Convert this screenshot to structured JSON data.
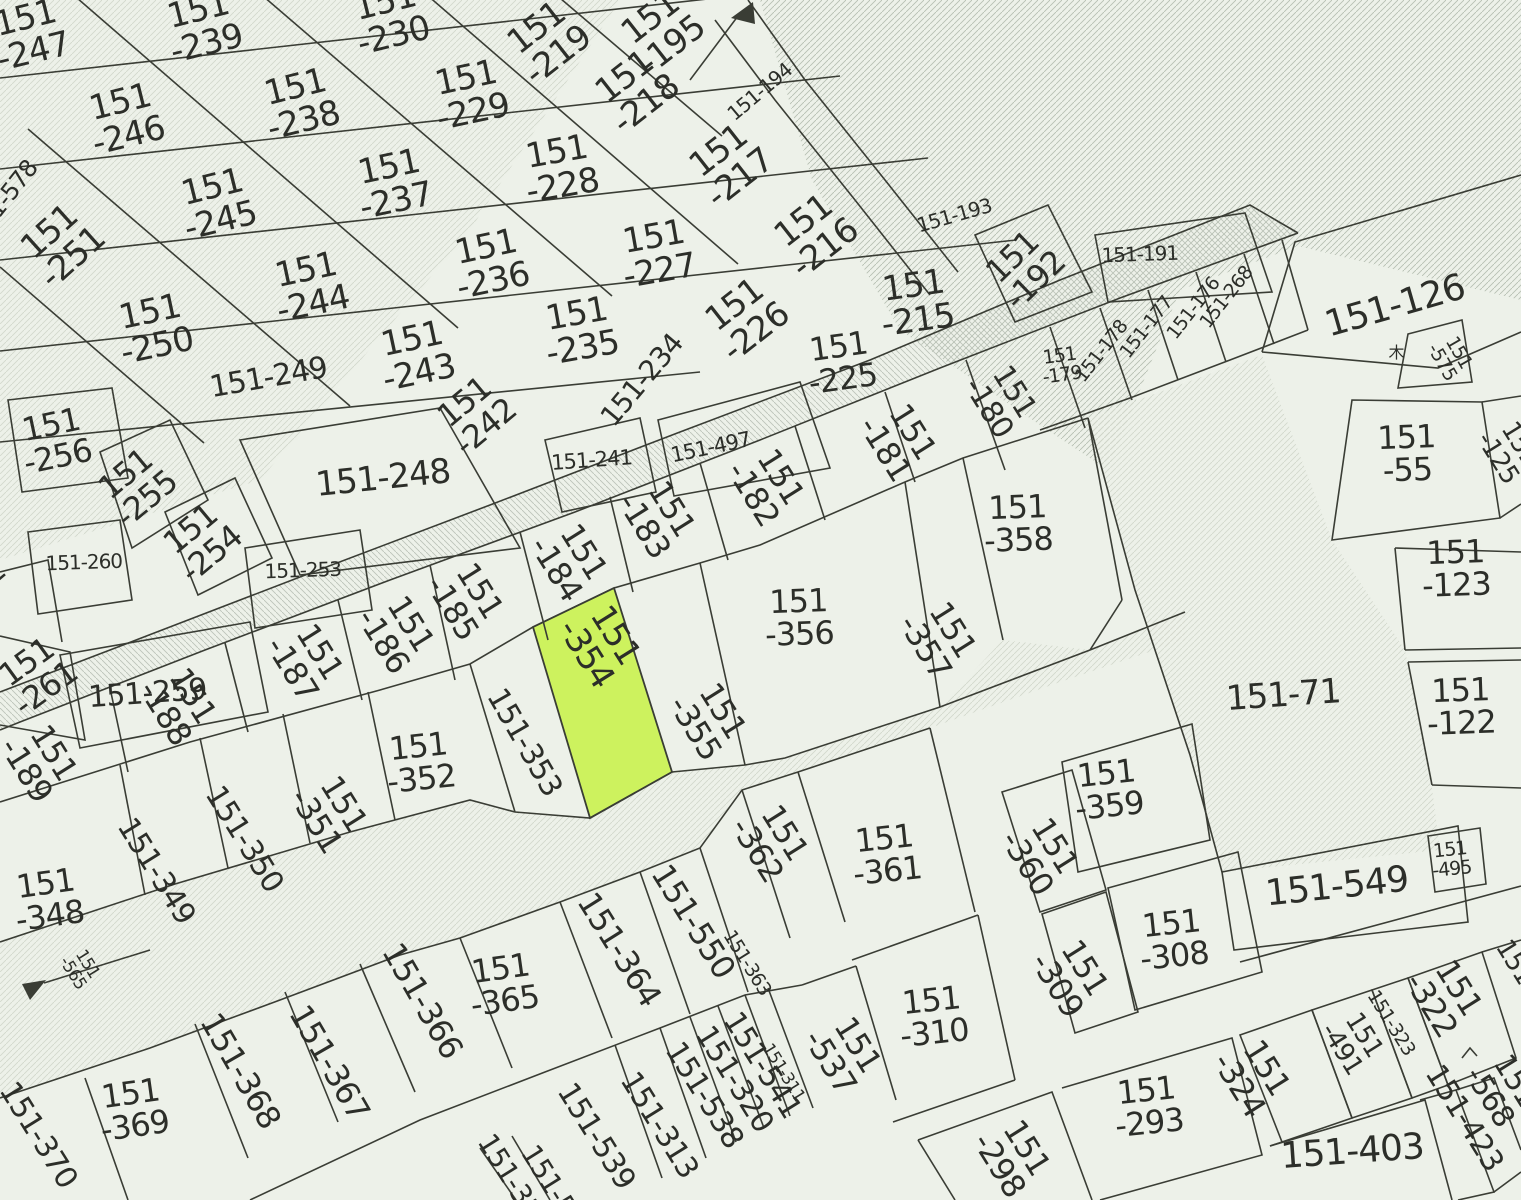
{
  "map": {
    "title": "cadastral-parcel-map",
    "width": 1521,
    "height": 1200,
    "background_color": "#edf1e9",
    "line_color": "#3a3d35",
    "label_color": "#2c2e29",
    "highlight_color": "#cdf25e",
    "hatch_color_strong": "#b7c0b3",
    "hatch_color_mid": "#bcc4ba",
    "hatch_color_faint": "#d2d8cc",
    "highlighted_parcel": "151-354",
    "tree_symbol": "木"
  },
  "parcels": [
    {
      "t": "151-247",
      "x": 30,
      "y": 38,
      "r": -14,
      "s": 34,
      "l": 2
    },
    {
      "t": "151-239",
      "x": 203,
      "y": 30,
      "r": -14,
      "s": 34,
      "l": 2
    },
    {
      "t": "151-230",
      "x": 390,
      "y": 22,
      "r": -14,
      "s": 34,
      "l": 2
    },
    {
      "t": "151-219",
      "x": 549,
      "y": 44,
      "r": -38,
      "s": 34,
      "l": 2
    },
    {
      "t": "151-195",
      "x": 663,
      "y": 34,
      "r": -38,
      "s": 34,
      "l": 2
    },
    {
      "t": "151-246",
      "x": 125,
      "y": 122,
      "r": -14,
      "s": 34,
      "l": 2
    },
    {
      "t": "151-238",
      "x": 300,
      "y": 107,
      "r": -14,
      "s": 34,
      "l": 2
    },
    {
      "t": "151-229",
      "x": 470,
      "y": 98,
      "r": -12,
      "s": 34,
      "l": 2
    },
    {
      "t": "151-218",
      "x": 637,
      "y": 93,
      "r": -38,
      "s": 34,
      "l": 2
    },
    {
      "t": "151-194",
      "x": 764,
      "y": 97,
      "r": -40,
      "s": 20,
      "l": 1
    },
    {
      "t": "151-245",
      "x": 217,
      "y": 207,
      "r": -14,
      "s": 34,
      "l": 2
    },
    {
      "t": "151-237",
      "x": 393,
      "y": 187,
      "r": -12,
      "s": 34,
      "l": 2
    },
    {
      "t": "151-228",
      "x": 560,
      "y": 172,
      "r": -10,
      "s": 34,
      "l": 2
    },
    {
      "t": "151-217",
      "x": 731,
      "y": 167,
      "r": -38,
      "s": 34,
      "l": 2
    },
    {
      "t": "151-578",
      "x": 10,
      "y": 205,
      "r": -52,
      "s": 24,
      "l": 1
    },
    {
      "t": "151-251",
      "x": 63,
      "y": 247,
      "r": -42,
      "s": 34,
      "l": 2
    },
    {
      "t": "151-244",
      "x": 310,
      "y": 290,
      "r": -12,
      "s": 34,
      "l": 2
    },
    {
      "t": "151-236",
      "x": 490,
      "y": 267,
      "r": -12,
      "s": 34,
      "l": 2
    },
    {
      "t": "151-227",
      "x": 657,
      "y": 257,
      "r": -10,
      "s": 34,
      "l": 2
    },
    {
      "t": "151-216",
      "x": 816,
      "y": 237,
      "r": -38,
      "s": 34,
      "l": 2
    },
    {
      "t": "151-193",
      "x": 956,
      "y": 222,
      "r": -16,
      "s": 20,
      "l": 1
    },
    {
      "t": "151-192",
      "x": 1026,
      "y": 271,
      "r": -44,
      "s": 32,
      "l": 2
    },
    {
      "t": "151-191",
      "x": 1140,
      "y": 261,
      "r": -2,
      "s": 20,
      "l": 1
    },
    {
      "t": "151-250",
      "x": 154,
      "y": 332,
      "r": -12,
      "s": 34,
      "l": 2
    },
    {
      "t": "151-243",
      "x": 416,
      "y": 359,
      "r": -12,
      "s": 34,
      "l": 2
    },
    {
      "t": "151-235",
      "x": 580,
      "y": 334,
      "r": -10,
      "s": 34,
      "l": 2
    },
    {
      "t": "151-226",
      "x": 747,
      "y": 321,
      "r": -38,
      "s": 34,
      "l": 2
    },
    {
      "t": "151-215",
      "x": 916,
      "y": 306,
      "r": -8,
      "s": 34,
      "l": 2
    },
    {
      "t": "151-257",
      "x": -50,
      "y": 362,
      "r": -52,
      "s": 30,
      "l": 1
    },
    {
      "t": "151-268",
      "x": 1231,
      "y": 301,
      "r": -52,
      "s": 19,
      "l": 1
    },
    {
      "t": "151-176",
      "x": 1198,
      "y": 312,
      "r": -52,
      "s": 19,
      "l": 1
    },
    {
      "t": "151-177",
      "x": 1151,
      "y": 331,
      "r": -52,
      "s": 19,
      "l": 1
    },
    {
      "t": "151-178",
      "x": 1106,
      "y": 355,
      "r": -52,
      "s": 19,
      "l": 1
    },
    {
      "t": "151-179",
      "x": 1061,
      "y": 367,
      "r": -8,
      "s": 19,
      "l": 2
    },
    {
      "t": "151-249",
      "x": 270,
      "y": 387,
      "r": -10,
      "s": 30,
      "l": 1
    },
    {
      "t": "151-242",
      "x": 477,
      "y": 417,
      "r": -40,
      "s": 32,
      "l": 2
    },
    {
      "t": "151-234",
      "x": 649,
      "y": 386,
      "r": -50,
      "s": 28,
      "l": 1
    },
    {
      "t": "151-225",
      "x": 841,
      "y": 366,
      "r": -8,
      "s": 32,
      "l": 2
    },
    {
      "t": "151-180",
      "x": 999,
      "y": 401,
      "r": 58,
      "s": 30,
      "l": 2
    },
    {
      "t": "151-126",
      "x": 1398,
      "y": 317,
      "r": -16,
      "s": 36,
      "l": 1
    },
    {
      "t": "151-575",
      "x": 1449,
      "y": 358,
      "r": 60,
      "s": 19,
      "l": 2
    },
    {
      "t": "151-125",
      "x": 1507,
      "y": 452,
      "r": 58,
      "s": 26,
      "l": 2
    },
    {
      "t": "151-256",
      "x": 55,
      "y": 444,
      "r": -12,
      "s": 32,
      "l": 2
    },
    {
      "t": "151-255",
      "x": 138,
      "y": 489,
      "r": -40,
      "s": 32,
      "l": 2
    },
    {
      "t": "151-248",
      "x": 384,
      "y": 489,
      "r": -6,
      "s": 34,
      "l": 1
    },
    {
      "t": "151-241",
      "x": 592,
      "y": 467,
      "r": -4,
      "s": 21,
      "l": 1
    },
    {
      "t": "151-497",
      "x": 712,
      "y": 454,
      "r": -12,
      "s": 21,
      "l": 1
    },
    {
      "t": "151-181",
      "x": 896,
      "y": 442,
      "r": 58,
      "s": 32,
      "l": 2
    },
    {
      "t": "151-254",
      "x": 203,
      "y": 544,
      "r": -40,
      "s": 32,
      "l": 2
    },
    {
      "t": "151-260",
      "x": 84,
      "y": 569,
      "r": -2,
      "s": 20,
      "l": 1
    },
    {
      "t": "151-253",
      "x": 303,
      "y": 577,
      "r": -2,
      "s": 20,
      "l": 1
    },
    {
      "t": "151-183",
      "x": 655,
      "y": 519,
      "r": 58,
      "s": 32,
      "l": 2
    },
    {
      "t": "151-182",
      "x": 764,
      "y": 487,
      "r": 58,
      "s": 32,
      "l": 2
    },
    {
      "t": "151-358",
      "x": 1018,
      "y": 527,
      "r": -2,
      "s": 32,
      "l": 2
    },
    {
      "t": "151-184",
      "x": 567,
      "y": 562,
      "r": 58,
      "s": 32,
      "l": 2
    },
    {
      "t": "151-262",
      "x": -38,
      "y": 612,
      "r": -40,
      "s": 30,
      "l": 1
    },
    {
      "t": "151-259",
      "x": 148,
      "y": 703,
      "r": -4,
      "s": 30,
      "l": 1
    },
    {
      "t": "151-185",
      "x": 463,
      "y": 601,
      "r": 58,
      "s": 32,
      "l": 2
    },
    {
      "t": "151-186",
      "x": 394,
      "y": 634,
      "r": 58,
      "s": 32,
      "l": 2
    },
    {
      "t": "151-55",
      "x": 1407,
      "y": 457,
      "r": -2,
      "s": 32,
      "l": 2
    },
    {
      "t": "151-354",
      "x": 598,
      "y": 646,
      "r": 58,
      "s": 34,
      "l": 2
    },
    {
      "t": "151-123",
      "x": 1456,
      "y": 572,
      "r": -2,
      "s": 32,
      "l": 2
    },
    {
      "t": "151-357",
      "x": 936,
      "y": 640,
      "r": 58,
      "s": 32,
      "l": 2
    },
    {
      "t": "151-356",
      "x": 799,
      "y": 621,
      "r": -2,
      "s": 32,
      "l": 2
    },
    {
      "t": "151-261",
      "x": 38,
      "y": 678,
      "r": -36,
      "s": 32,
      "l": 2
    },
    {
      "t": "151-187",
      "x": 303,
      "y": 662,
      "r": 58,
      "s": 32,
      "l": 2
    },
    {
      "t": "151-188",
      "x": 176,
      "y": 706,
      "r": 58,
      "s": 32,
      "l": 2
    },
    {
      "t": "151-355",
      "x": 706,
      "y": 721,
      "r": 58,
      "s": 32,
      "l": 2
    },
    {
      "t": "151-122",
      "x": 1461,
      "y": 710,
      "r": -2,
      "s": 32,
      "l": 2
    },
    {
      "t": "151-71",
      "x": 1284,
      "y": 706,
      "r": -4,
      "s": 34,
      "l": 1
    },
    {
      "t": "151-189",
      "x": 37,
      "y": 763,
      "r": 58,
      "s": 32,
      "l": 2
    },
    {
      "t": "151-353",
      "x": 516,
      "y": 747,
      "r": 60,
      "s": 30,
      "l": 1
    },
    {
      "t": "151-352",
      "x": 420,
      "y": 766,
      "r": -6,
      "s": 32,
      "l": 2
    },
    {
      "t": "151-351",
      "x": 327,
      "y": 814,
      "r": 58,
      "s": 32,
      "l": 2
    },
    {
      "t": "151-350",
      "x": 236,
      "y": 844,
      "r": 58,
      "s": 30,
      "l": 1
    },
    {
      "t": "151-349",
      "x": 148,
      "y": 876,
      "r": 58,
      "s": 30,
      "l": 1
    },
    {
      "t": "151-359",
      "x": 1108,
      "y": 793,
      "r": -6,
      "s": 32,
      "l": 2
    },
    {
      "t": "151-348",
      "x": 48,
      "y": 903,
      "r": -8,
      "s": 32,
      "l": 2
    },
    {
      "t": "151-362",
      "x": 768,
      "y": 843,
      "r": 58,
      "s": 32,
      "l": 2
    },
    {
      "t": "151-361",
      "x": 886,
      "y": 858,
      "r": -6,
      "s": 32,
      "l": 2
    },
    {
      "t": "151-360",
      "x": 1038,
      "y": 856,
      "r": 58,
      "s": 32,
      "l": 2
    },
    {
      "t": "151-565",
      "x": 79,
      "y": 969,
      "r": 58,
      "s": 17,
      "l": 2
    },
    {
      "t": "151-549",
      "x": 1338,
      "y": 898,
      "r": -6,
      "s": 36,
      "l": 1
    },
    {
      "t": "151-495",
      "x": 1451,
      "y": 861,
      "r": -6,
      "s": 19,
      "l": 2
    },
    {
      "t": "151-364",
      "x": 610,
      "y": 955,
      "r": 58,
      "s": 32,
      "l": 1
    },
    {
      "t": "151-550",
      "x": 684,
      "y": 927,
      "r": 58,
      "s": 32,
      "l": 1
    },
    {
      "t": "151-363",
      "x": 742,
      "y": 966,
      "r": 58,
      "s": 19,
      "l": 1
    },
    {
      "t": "151-365",
      "x": 503,
      "y": 988,
      "r": -8,
      "s": 32,
      "l": 2
    },
    {
      "t": "151-310",
      "x": 933,
      "y": 1020,
      "r": -6,
      "s": 32,
      "l": 2
    },
    {
      "t": "151-308",
      "x": 1173,
      "y": 943,
      "r": -6,
      "s": 32,
      "l": 2
    },
    {
      "t": "151-309",
      "x": 1068,
      "y": 978,
      "r": 58,
      "s": 32,
      "l": 2
    },
    {
      "t": "151-366",
      "x": 413,
      "y": 1006,
      "r": 60,
      "s": 32,
      "l": 1
    },
    {
      "t": "151-322",
      "x": 1442,
      "y": 998,
      "r": 58,
      "s": 32,
      "l": 2
    },
    {
      "t": "151-323",
      "x": 1386,
      "y": 1026,
      "r": 58,
      "s": 19,
      "l": 1
    },
    {
      "t": "151-491",
      "x": 1351,
      "y": 1043,
      "r": 58,
      "s": 26,
      "l": 2
    },
    {
      "t": "151-32",
      "x": 1518,
      "y": 983,
      "r": 58,
      "s": 26,
      "l": 1
    },
    {
      "t": "151-367",
      "x": 320,
      "y": 1068,
      "r": 60,
      "s": 32,
      "l": 1
    },
    {
      "t": "151-368",
      "x": 231,
      "y": 1076,
      "r": 60,
      "s": 32,
      "l": 1
    },
    {
      "t": "151-369",
      "x": 133,
      "y": 1113,
      "r": -8,
      "s": 32,
      "l": 2
    },
    {
      "t": "151-370",
      "x": 30,
      "y": 1140,
      "r": 58,
      "s": 30,
      "l": 1
    },
    {
      "t": "151-539",
      "x": 588,
      "y": 1141,
      "r": 58,
      "s": 30,
      "l": 1
    },
    {
      "t": "151-313",
      "x": 651,
      "y": 1130,
      "r": 58,
      "s": 30,
      "l": 1
    },
    {
      "t": "151-538",
      "x": 696,
      "y": 1100,
      "r": 58,
      "s": 30,
      "l": 1
    },
    {
      "t": "151-320",
      "x": 726,
      "y": 1084,
      "r": 58,
      "s": 30,
      "l": 1
    },
    {
      "t": "151-541",
      "x": 754,
      "y": 1070,
      "r": 58,
      "s": 30,
      "l": 1
    },
    {
      "t": "151-311",
      "x": 779,
      "y": 1075,
      "r": 58,
      "s": 17,
      "l": 1
    },
    {
      "t": "151-537",
      "x": 841,
      "y": 1055,
      "r": 58,
      "s": 32,
      "l": 2
    },
    {
      "t": "151-314",
      "x": 506,
      "y": 1188,
      "r": 58,
      "s": 28,
      "l": 1
    },
    {
      "t": "151-54",
      "x": 545,
      "y": 1192,
      "r": 58,
      "s": 28,
      "l": 1
    },
    {
      "t": "151-298",
      "x": 1010,
      "y": 1158,
      "r": 58,
      "s": 32,
      "l": 2
    },
    {
      "t": "151-293",
      "x": 1148,
      "y": 1110,
      "r": -6,
      "s": 32,
      "l": 2
    },
    {
      "t": "151-324",
      "x": 1250,
      "y": 1078,
      "r": 58,
      "s": 32,
      "l": 2
    },
    {
      "t": "151-403",
      "x": 1353,
      "y": 1163,
      "r": -4,
      "s": 36,
      "l": 1
    },
    {
      "t": "151-423",
      "x": 1456,
      "y": 1123,
      "r": 58,
      "s": 30,
      "l": 1
    },
    {
      "t": "151-568",
      "x": 1500,
      "y": 1090,
      "r": 58,
      "s": 30,
      "l": 2
    }
  ]
}
